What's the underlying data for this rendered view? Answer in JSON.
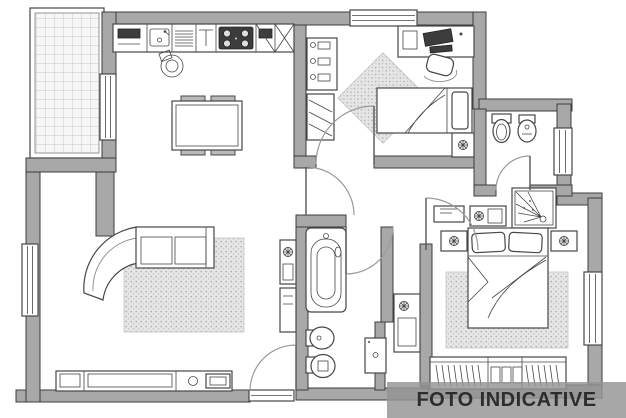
{
  "watermark": {
    "text": "FOTO INDICATIVE"
  },
  "colors": {
    "background": "#ffffff",
    "wall_fill": "#a8a8a8",
    "wall_stroke": "#3d3d3d",
    "line": "#474747",
    "light_line": "#8a8a8a",
    "rug_fill": "#e6e6e6",
    "rug_dot": "#adadad",
    "tile_bg": "#f7f7f7",
    "tile_line": "#bcbcbc",
    "appliance_dark": "#3c3c3c",
    "chair_fill": "#b9b9b9",
    "watermark_bg": "rgba(148,148,148,0.82)",
    "watermark_text": "#2d2d2d"
  },
  "floorplan": {
    "type": "apartment floor plan, black and white architectural drawing",
    "rooms": [
      "terrace",
      "kitchen-dining",
      "living-room",
      "bedroom-1",
      "bathroom-1",
      "hallway",
      "bathroom-2",
      "corridor",
      "master-bedroom"
    ],
    "fixtures": [
      "kitchen-counter",
      "kitchen-sink",
      "stove",
      "dining-table",
      "dining-chairs",
      "stool",
      "coat-rack",
      "shoe-rack",
      "desk",
      "desk-chair",
      "single-bed",
      "nightstand",
      "area-rug",
      "toilet",
      "bidet",
      "shower",
      "bathtub",
      "washing-machine",
      "utility-cabinet",
      "sofa",
      "tv-sideboard",
      "tv",
      "double-bed",
      "wardrobe",
      "windows",
      "interior-doors",
      "entrance-door"
    ]
  }
}
